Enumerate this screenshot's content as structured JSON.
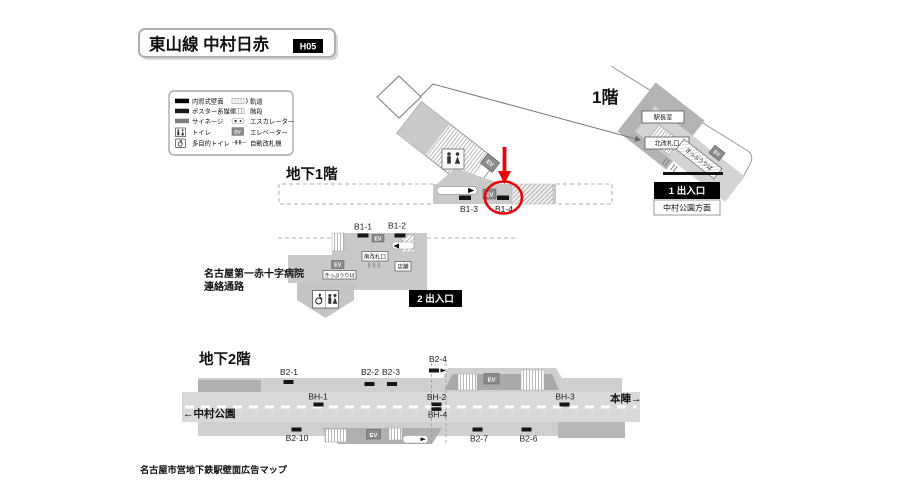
{
  "title": {
    "line": "東山線 中村日赤",
    "code": "H05"
  },
  "ev": "EV",
  "legend": {
    "left": [
      {
        "label": "内照式壁面"
      },
      {
        "label": "ポスター系媒体"
      },
      {
        "label": "サイネージ"
      },
      {
        "label": "トイレ"
      },
      {
        "label": "多目的トイレ"
      }
    ],
    "right": [
      {
        "label": "軌道"
      },
      {
        "label": "階段"
      },
      {
        "label": "エスカレーター"
      },
      {
        "label": "エレベーター"
      },
      {
        "label": "自動改札機"
      }
    ]
  },
  "floor1": {
    "heading": "1階",
    "station_office": "駅長室",
    "gate": "北改札口",
    "ticket": "きっぷうりば",
    "exit_no": "1 出入口",
    "exit_dir": "中村公園方面"
  },
  "b1": {
    "heading": "地下1階",
    "ads": [
      "B1-1",
      "B1-2",
      "B1-3",
      "B1-4"
    ],
    "gate": "南改札口",
    "shop": "店舗",
    "ticket": "きっぷうりば",
    "exit": "2 出入口",
    "hospital_line1": "名古屋第一赤十字病院",
    "hospital_line2": "連絡通路"
  },
  "b2": {
    "heading": "地下2階",
    "ads_top": [
      "B2-1",
      "B2-2",
      "B2-3",
      "B2-4"
    ],
    "ads_bh": [
      "BH-1",
      "BH-2",
      "BH-3",
      "BH-4"
    ],
    "ads_bottom": [
      "B2-10",
      "B2-7",
      "B2-6"
    ],
    "dir_left": "←中村公園",
    "dir_right": "本陣→"
  },
  "caption": "名古屋市営地下鉄駅壁面広告マップ",
  "colors": {
    "highlight_red": "#e8000b",
    "ad_black": "#151515",
    "platform_gray": "#cfcfcf",
    "exit_box_black": "#000000"
  }
}
